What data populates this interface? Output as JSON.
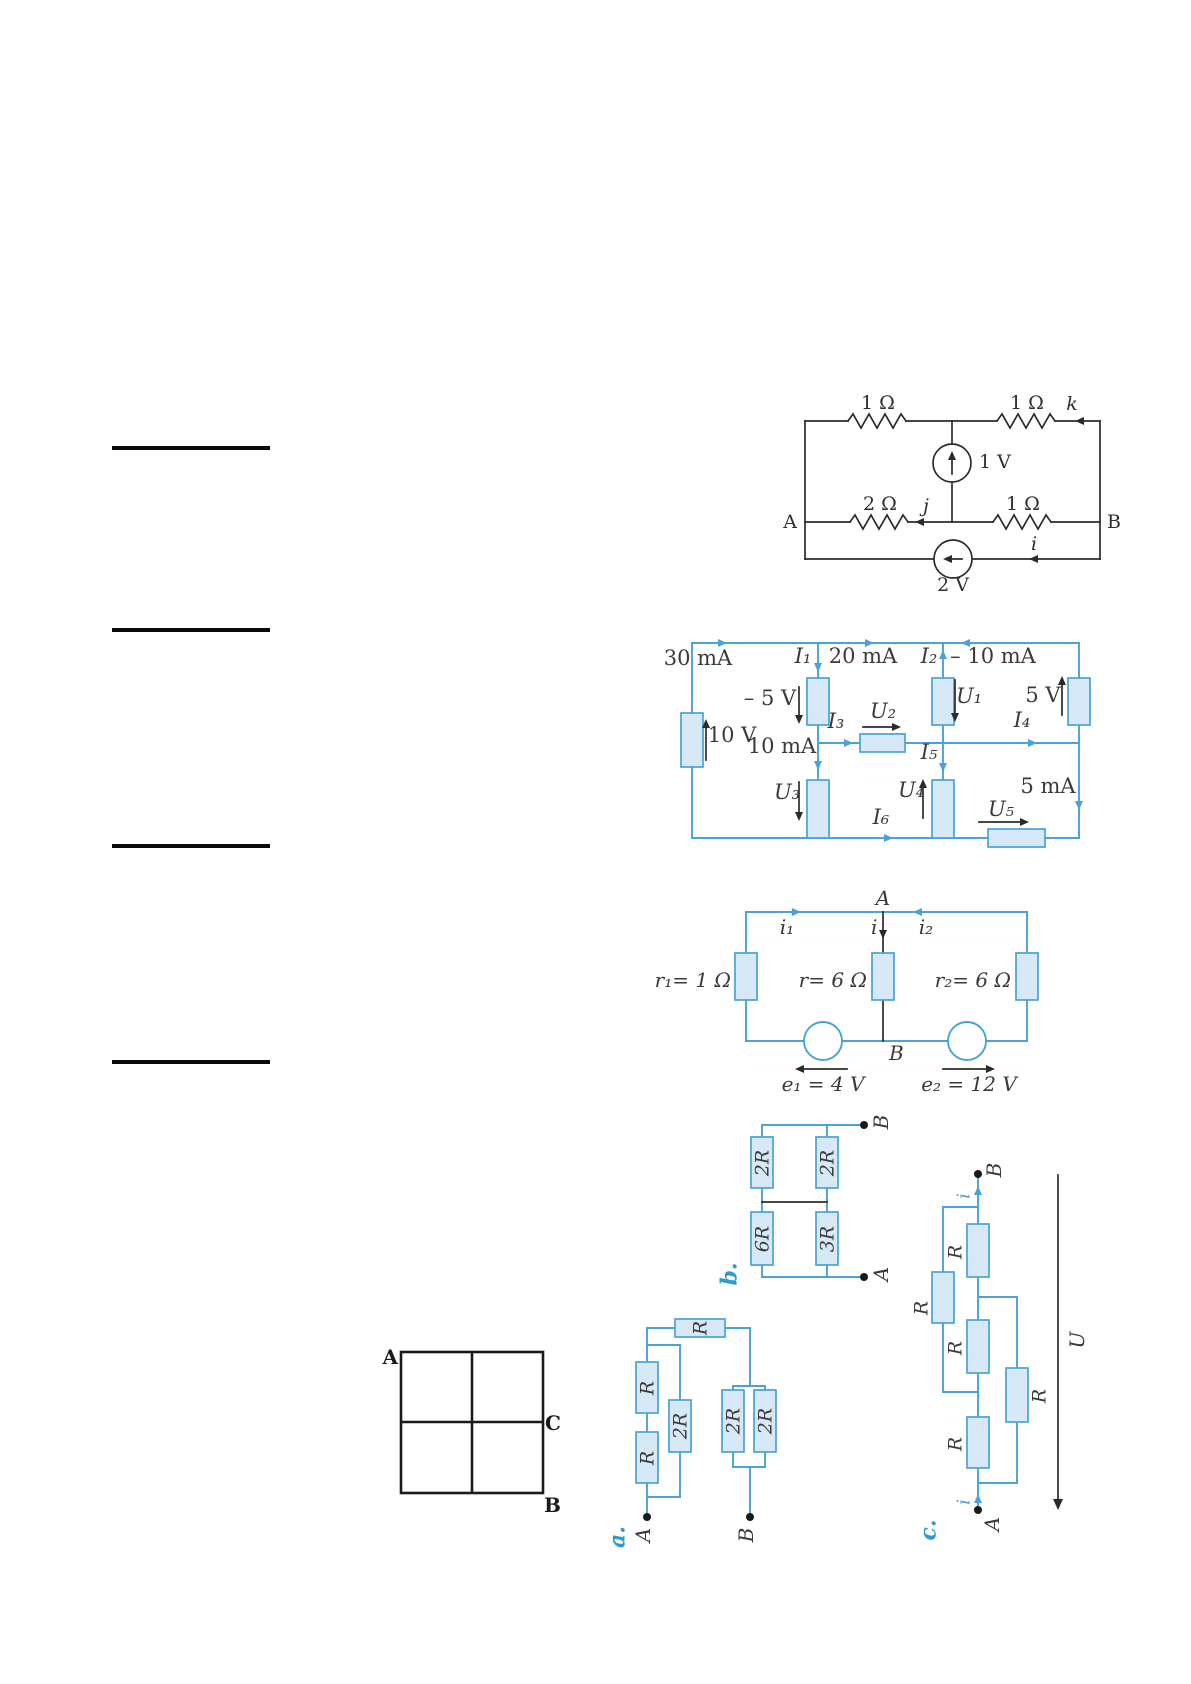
{
  "colors": {
    "circuit_blue": "#4aa2d6",
    "resistor_fill": "#d7e8f6",
    "ink_black": "#2b2b2b",
    "label_gray": "#3a3a3a",
    "tag_blue": "#2e9bd0"
  },
  "fig_top_circuit": {
    "r_top_left": "1 Ω",
    "r_top_right": "1 Ω",
    "cur_k": "k",
    "src_top": "1 V",
    "node_a": "A",
    "r_mid_left": "2 Ω",
    "cur_j": "j",
    "r_mid_right": "1 Ω",
    "node_b": "B",
    "cur_i": "i",
    "src_bottom": "2 V"
  },
  "fig_currents": {
    "i30": "30 mA",
    "I1": "I₁",
    "i20": "20 mA",
    "I2": "I₂",
    "im10": "– 10 mA",
    "um5": "– 5 V",
    "U1": "U₁",
    "u5": "5 V",
    "u10": "10 V",
    "I3": "I₃",
    "U2": "U₂",
    "I4": "I₄",
    "i10": "10 mA",
    "I5": "I₅",
    "U3": "U₃",
    "U4": "U₄",
    "i5": "5 mA",
    "I6": "I₆",
    "U5": "U₅"
  },
  "fig_emf": {
    "node_a": "A",
    "i1": "i₁",
    "i": "i",
    "i2": "i₂",
    "r1": "r₁= 1 Ω",
    "r": "r= 6 Ω",
    "r2": "r₂= 6 Ω",
    "node_b": "B",
    "e1": "e₁ = 4 V",
    "e2": "e₂ = 12 V"
  },
  "fig_square": {
    "a": "A",
    "c": "C",
    "b": "B"
  },
  "fig_a": {
    "tag": "a.",
    "r_top": "R",
    "r_s1": "R",
    "r_s2": "R",
    "r_p": "2R",
    "r_p1": "2R",
    "r_p2": "2R",
    "term_a": "A",
    "term_b": "B"
  },
  "fig_b": {
    "tag": "b.",
    "r1": "2R",
    "r2": "2R",
    "r3": "6R",
    "r4": "3R",
    "term_a": "A",
    "term_b": "B"
  },
  "fig_c": {
    "tag": "c.",
    "r1": "R",
    "r2": "R",
    "r3": "R",
    "r4": "R",
    "r5": "R",
    "i_top": "i",
    "i_bot": "i",
    "u": "U",
    "term_a": "A",
    "term_b": "B"
  }
}
